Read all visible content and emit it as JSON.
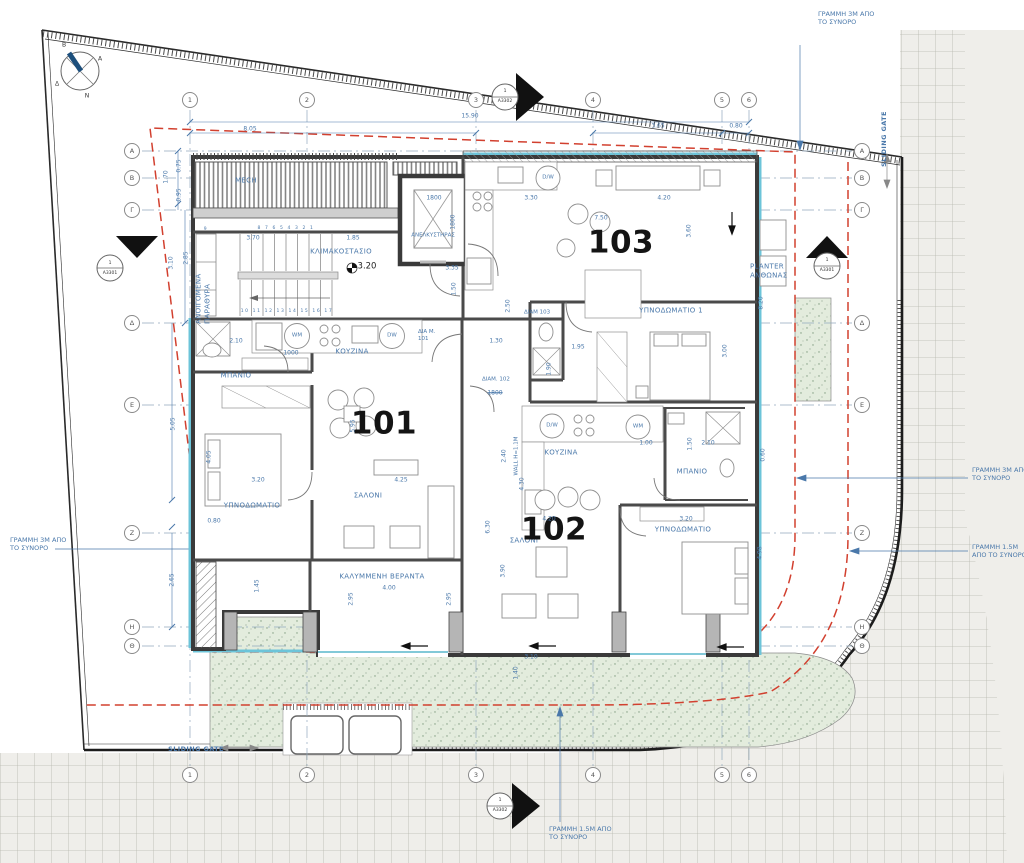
{
  "plan": {
    "apartments": {
      "a101": "101",
      "a102": "102",
      "a103": "103"
    },
    "rooms": {
      "mech": "MECH",
      "elevator": "ΑΝΕΛΚΥΣΤΗΡΑΣ",
      "staircase": "ΚΛΙΜΑΚΟΣΤΑΣΙΟ",
      "kitchen_101": "ΚΟΥΖΙΝΑ",
      "kitchen_102": "ΚΟΥΖΙΝΑ",
      "bathroom_101": "ΜΠΑΝΙΟ",
      "bathroom_102": "ΜΠΑΝΙΟ",
      "bedroom_101": "ΥΠΝΟΔΩΜΑΤΙΟ",
      "bedroom_102": "ΥΠΝΟΔΩΜΑΤΙΟ",
      "bedroom1_102": "ΥΠΝΟΔΩΜΑΤΙΟ 1",
      "living_101": "ΣΑΛΟΝΙ",
      "living_102": "ΣΑΛΟΝΙ",
      "veranda": "ΚΑΛΥΜΜΕΝΗ ΒΕΡΑΝΤΑ",
      "planter": "PLANTER ΑΝΘΩΝΑΣ",
      "openable_windows": "ΑΝΟΙΓΟΜΕΝΑ ΠΑΡΑΘΥΡΑ"
    },
    "unit_tags": {
      "u101": "ΔΙΑ Μ. 101",
      "u102": "ΔΙΑΜ. 102",
      "u103": "ΔΙΑΜ 103"
    },
    "appliances": {
      "wm": "WM",
      "dw": "DW",
      "dws": "D/W"
    },
    "notes": {
      "line_3m": "ΓΡΑΜΜΗ 3Μ ΑΠΟ ΤΟ ΣΥΝΟΡΟ",
      "line_15m": "ΓΡΑΜΜΗ 1.5Μ ΑΠΟ ΤΟ ΣΥΝΟΡΟ",
      "sliding_gate": "SLIDING GATE",
      "wall_height": "WALL H=1.1M",
      "level": "3.20"
    },
    "grid": {
      "columns": [
        "1",
        "2",
        "3",
        "4",
        "5",
        "6"
      ],
      "rows": [
        "A",
        "B",
        "Γ",
        "Δ",
        "Ε",
        "Ζ",
        "Η",
        "Θ"
      ]
    },
    "sections": {
      "a3301": {
        "number": "1",
        "sheet": "A3301"
      },
      "a3302": {
        "number": "1",
        "sheet": "A3302"
      }
    },
    "compass": {
      "north": "Β",
      "east": "Α",
      "south": "Ν",
      "west": "Δ"
    },
    "stairs": {
      "step_left": "9",
      "steps_upper": "8 7 6 5 4 3 2 1",
      "steps_lower": "10 11 12 13 14 15 16 17"
    },
    "dimensions": {
      "top_total": "15.90",
      "top_1_3": "8.05",
      "top_4_5": "3.65",
      "top_5_6": "0.80",
      "left_075": "0.75",
      "left_170": "1.70",
      "left_095": "0.95",
      "left_285": "2.85",
      "left_310": "3.10",
      "left_505": "5.05",
      "left_265": "2.65",
      "stair_370": "3.70",
      "stair_185": "1.85",
      "lift_w": "1800",
      "lift_d": "1800",
      "lift_335": "3.35",
      "lift_150": "1.50",
      "lift_250": "2.50",
      "hall_130": "1.30",
      "hall_195": "1.95",
      "hall_190": "1.90",
      "hall_240": "2.40",
      "hall_430": "4.30",
      "bath101_210": "2.10",
      "kitchen101_1000": "1000",
      "k103_330": "3.30",
      "s103_420": "4.20",
      "s103_750": "7.50",
      "s103_360": "3.60",
      "bed1_300": "3.00",
      "right_820": "8.20",
      "bed101_405": "4.05",
      "bed101_320": "3.20",
      "bed101_080": "0.80",
      "liv101_425": "4.25",
      "liv101_595": "5.95",
      "liv101_630": "6.30",
      "k102_100": "1.00",
      "b102_150": "1.50",
      "b102_210": "2.10",
      "r_060": "0.60",
      "r_498": "4.98",
      "liv102_420": "4.20",
      "bed102_320": "3.20",
      "liv102_390": "3.90",
      "ver_400": "4.00",
      "ver_295a": "2.95",
      "ver_295b": "2.95",
      "ver_145": "1.45",
      "bot_310": "3.10",
      "bot_140": "1.40",
      "tag1800": "1800"
    }
  }
}
